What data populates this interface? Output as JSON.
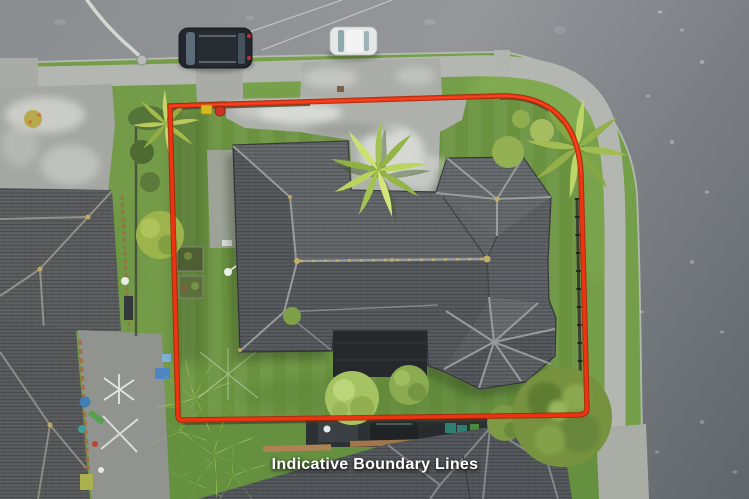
{
  "overlay": {
    "disclaimer_label": "Indicative Boundary Lines",
    "boundary_color": "#ee3313",
    "label_color": "#ffffff"
  },
  "scene": {
    "type": "aerial-drone-photo",
    "objects": [
      "top-road",
      "right-road",
      "footpath",
      "grass-verge",
      "front-driveway",
      "main-house-hip-roof",
      "entry-turret-roof",
      "rear-gazebo-roof",
      "dark-pergola",
      "backyard-lawn",
      "garden-beds",
      "left-neighbor-house",
      "left-neighbor-patio",
      "bottom-neighbor-house",
      "parked-suv",
      "parked-white-car",
      "street-light",
      "palm-tree",
      "cabbage-tree",
      "boundary-fence",
      "wheelie-bins",
      "flax-plants",
      "corner-tree",
      "clothesline",
      "satellite-dish"
    ]
  },
  "palette": {
    "road": "#8d9093",
    "road_dark": "#646a6e",
    "footpath": "#b4b7b1",
    "concrete": "#a9aca6",
    "grass": "#749e49",
    "lawn": "#6a923f",
    "roof": "#5f6367",
    "roof_ridge": "#9fa3a2",
    "neighbor_roof": "#5c5e60",
    "pergola": "#26292c",
    "tree": "#76923f",
    "palm": "#b7d05f",
    "boundary_red": "#ee3313"
  }
}
